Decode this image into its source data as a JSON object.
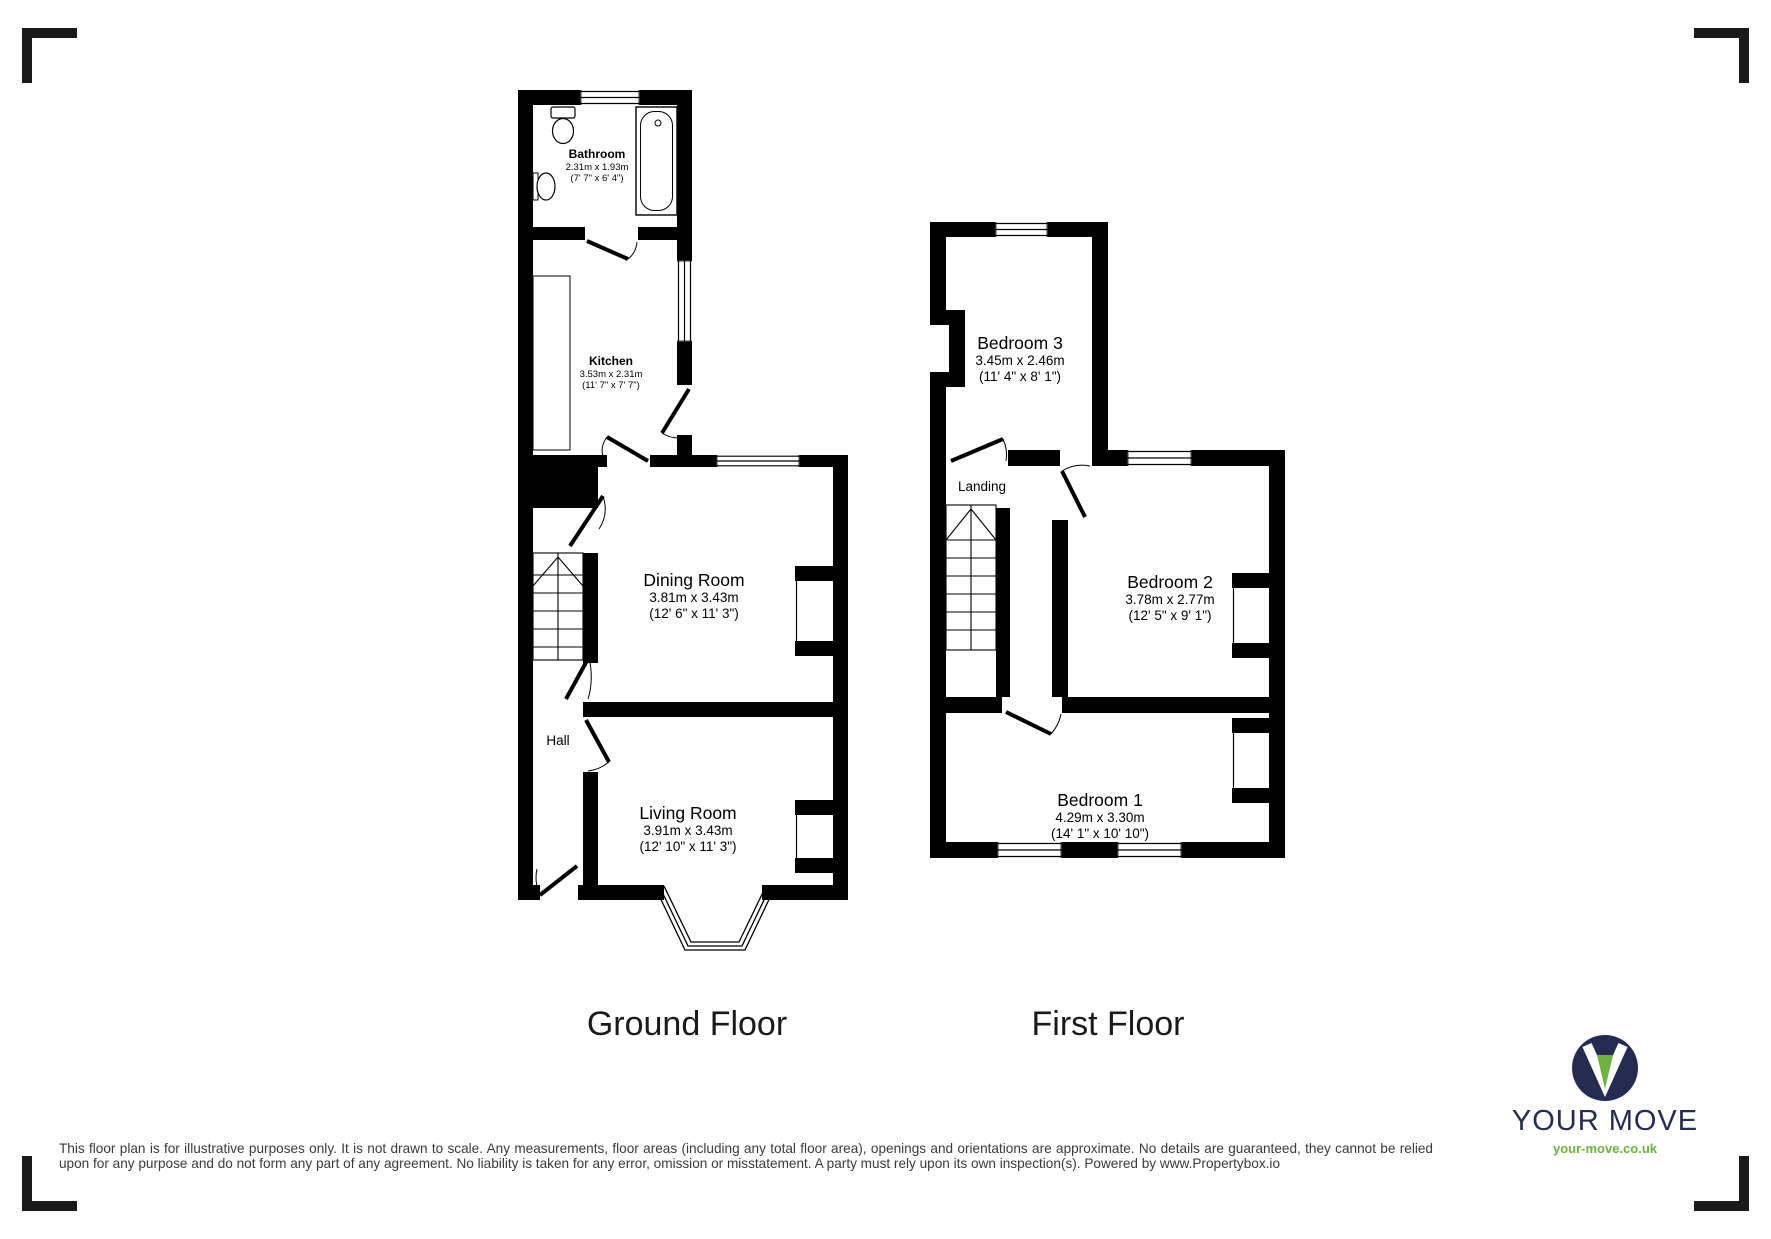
{
  "page": {
    "background": "#ffffff",
    "line_color": "#000000"
  },
  "floors": [
    {
      "id": "ground",
      "title": "Ground Floor",
      "rooms": [
        {
          "name": "Bathroom",
          "metric": "2.31m x 1.93m",
          "imperial": "(7' 7\" x 6' 4\")"
        },
        {
          "name": "Kitchen",
          "metric": "3.53m x 2.31m",
          "imperial": "(11' 7\" x 7' 7\")"
        },
        {
          "name": "Dining Room",
          "metric": "3.81m x 3.43m",
          "imperial": "(12' 6\" x 11' 3\")"
        },
        {
          "name": "Hall"
        },
        {
          "name": "Living Room",
          "metric": "3.91m x 3.43m",
          "imperial": "(12' 10\" x 11' 3\")"
        }
      ]
    },
    {
      "id": "first",
      "title": "First Floor",
      "rooms": [
        {
          "name": "Bedroom 3",
          "metric": "3.45m x 2.46m",
          "imperial": "(11' 4\" x 8' 1\")"
        },
        {
          "name": "Landing"
        },
        {
          "name": "Bedroom 2",
          "metric": "3.78m x 2.77m",
          "imperial": "(12' 5\" x 9' 1\")"
        },
        {
          "name": "Bedroom 1",
          "metric": "4.29m x 3.30m",
          "imperial": "(14' 1\" x 10' 10\")"
        }
      ]
    }
  ],
  "disclaimer": "This floor plan is for illustrative purposes only. It is not drawn to scale. Any measurements, floor areas (including any total floor area), openings and orientations are approximate. No details are guaranteed, they cannot be relied upon for any purpose and do not form any part of any agreement. No liability is taken for any error, omission or misstatement. A party must rely upon its own inspection(s). Powered by www.Propertybox.io",
  "logo": {
    "brand": "YOUR MOVE",
    "website": "your-move.co.uk",
    "navy": "#242C4F",
    "green": "#6DB33F"
  }
}
